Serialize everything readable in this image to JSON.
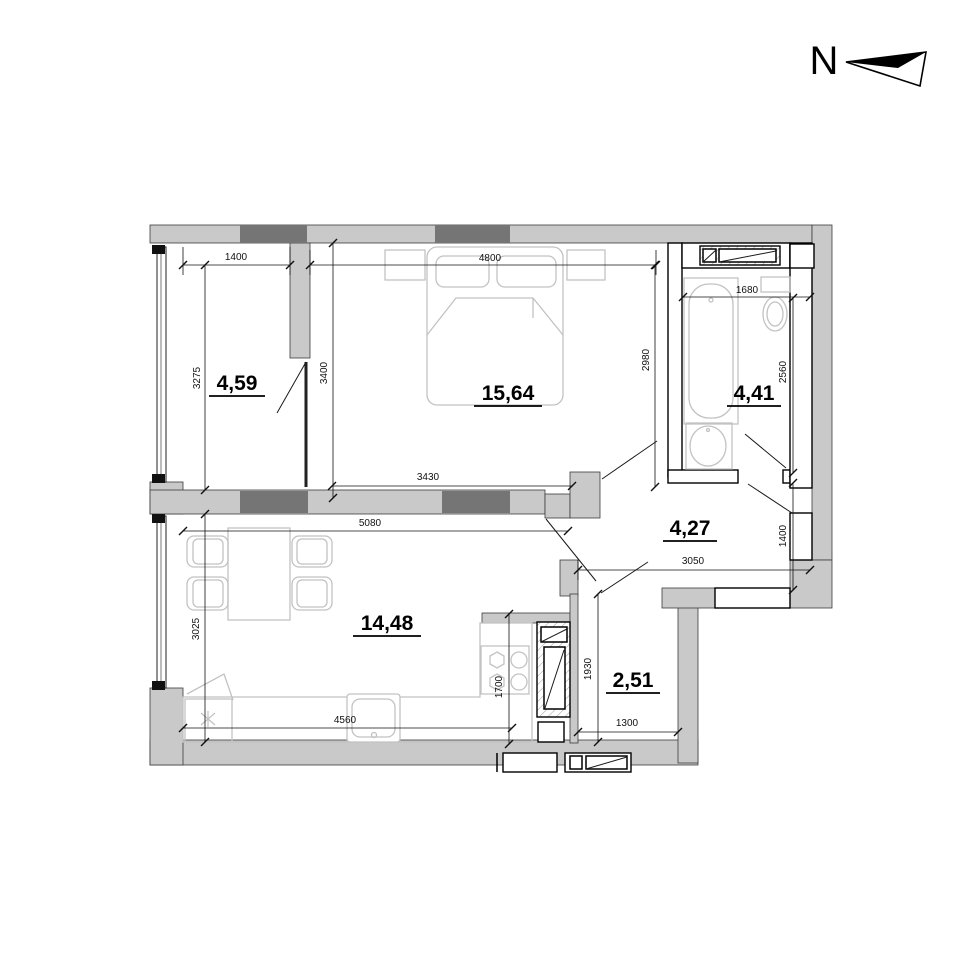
{
  "plan_title": "apartment floor plan",
  "north_arrow": {
    "label": "N"
  },
  "rooms": [
    {
      "name": "room-left",
      "area": "4,59"
    },
    {
      "name": "bedroom",
      "area": "15,64"
    },
    {
      "name": "bathroom",
      "area": "4,41"
    },
    {
      "name": "hall",
      "area": "4,27"
    },
    {
      "name": "living-kitchen",
      "area": "14,48"
    },
    {
      "name": "storage",
      "area": "2,51"
    }
  ],
  "dims": {
    "room1_width": "1400",
    "bedroom_width": "4800",
    "bathroom_width": "1680",
    "room1_height": "3275",
    "room1_door_wall": "3400",
    "bedroom_height": "2980",
    "bathroom_height": "2560",
    "bedroom_bottom_width": "3430",
    "living_width": "5080",
    "hall_height": "1400",
    "hall_width": "3050",
    "living_height": "3025",
    "kitchen_niche": "1700",
    "counter_length": "4560",
    "storage_height": "1930",
    "storage_width": "1300"
  },
  "colors": {
    "wall_fill": "#c9c9c9",
    "pylon_fill": "#757575",
    "furniture_stroke": "#c2c2c2",
    "line": "#111111",
    "background": "#ffffff"
  }
}
